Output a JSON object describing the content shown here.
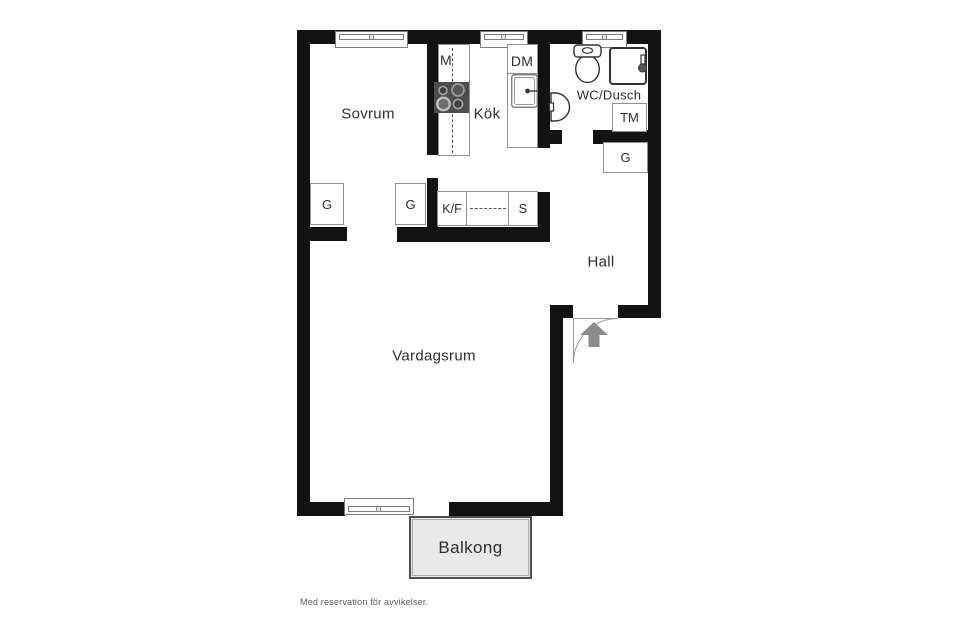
{
  "rooms": {
    "sovrum": {
      "label": "Sovrum"
    },
    "kok": {
      "label": "Kök"
    },
    "wc_dusch": {
      "label": "WC/Dusch"
    },
    "hall": {
      "label": "Hall"
    },
    "vardagsrum": {
      "label": "Vardagsrum"
    },
    "balkong": {
      "label": "Balkong"
    }
  },
  "appliances": {
    "microwave": "M",
    "dishwasher": "DM",
    "washing_machine": "TM",
    "fridge_freezer": "K/F",
    "pantry": "S",
    "wardrobe_bedroom": "G",
    "wardrobe_kitchen": "G",
    "wardrobe_hall": "G"
  },
  "footnote": "Med reservation för avvikelser.",
  "icons": {
    "stove": "stove-icon",
    "kitchen_sink": "sink-icon",
    "toilet": "toilet-icon",
    "shower": "shower-icon",
    "bathroom_sink": "washbasin-icon",
    "entry_arrow": "entry-arrow-icon",
    "door_swing": "door-swing-arc"
  },
  "colors": {
    "wall": "#121212",
    "outline": "#8f8f8f",
    "fixture_stroke": "#333333",
    "text": "#2e2e2e",
    "muted_text": "#5c5c5c",
    "balcony_fill": "#e9e9e9",
    "arrow": "#8c8c8c",
    "stove_fill": "#4c4c4c"
  }
}
